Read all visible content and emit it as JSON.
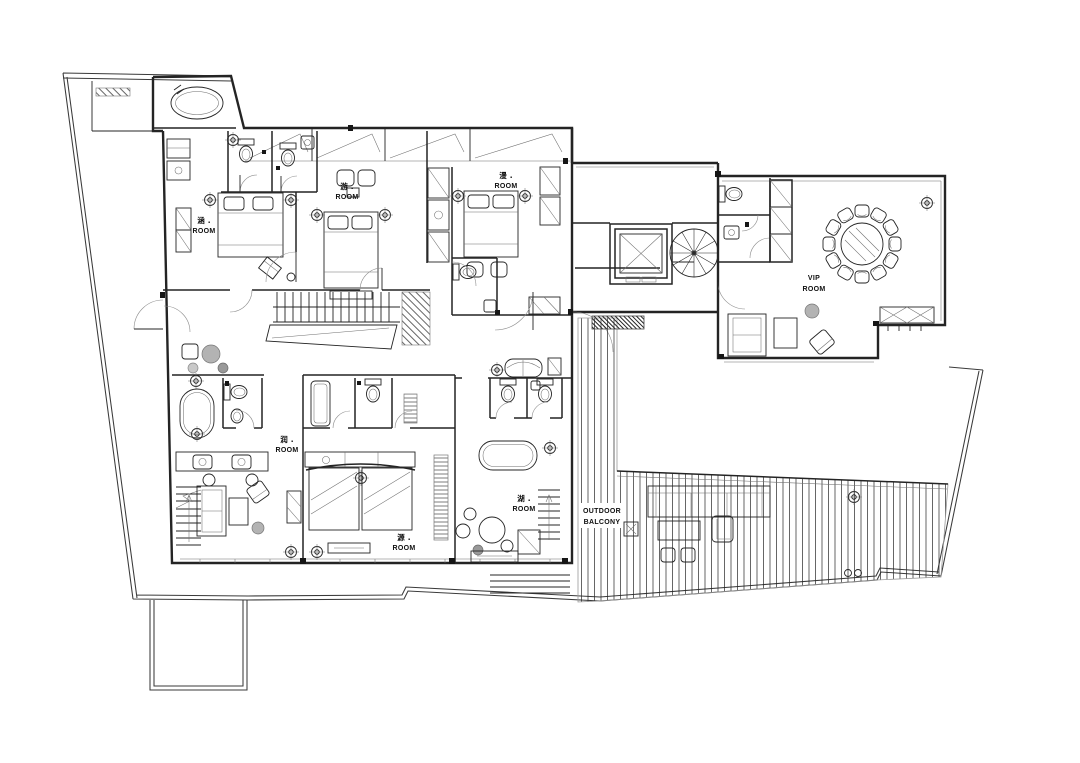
{
  "document": {
    "type": "residential-floor-plan",
    "background": "#ffffff",
    "ink": "#242424",
    "stone_gray": "#b3b3b3"
  },
  "rooms": [
    {
      "name": "涵 .",
      "type": "ROOM"
    },
    {
      "name": "游 .",
      "type": "ROOM"
    },
    {
      "name": "漫 .",
      "type": "ROOM"
    },
    {
      "name": "润 .",
      "type": "ROOM"
    },
    {
      "name": "源 .",
      "type": "ROOM"
    },
    {
      "name": "湖 .",
      "type": "ROOM"
    },
    {
      "name": "VIP",
      "type": "ROOM"
    }
  ],
  "outdoor": {
    "line1": "OUTDOOR",
    "line2": "BALCONY"
  },
  "features": [
    "site-boundary",
    "elevator",
    "spiral-staircase",
    "straight-staircase",
    "round-dining-table-12-chairs",
    "oval-hot-tub",
    "bathtub",
    "double-beds",
    "outdoor-deck",
    "garden-stepping-stones"
  ]
}
